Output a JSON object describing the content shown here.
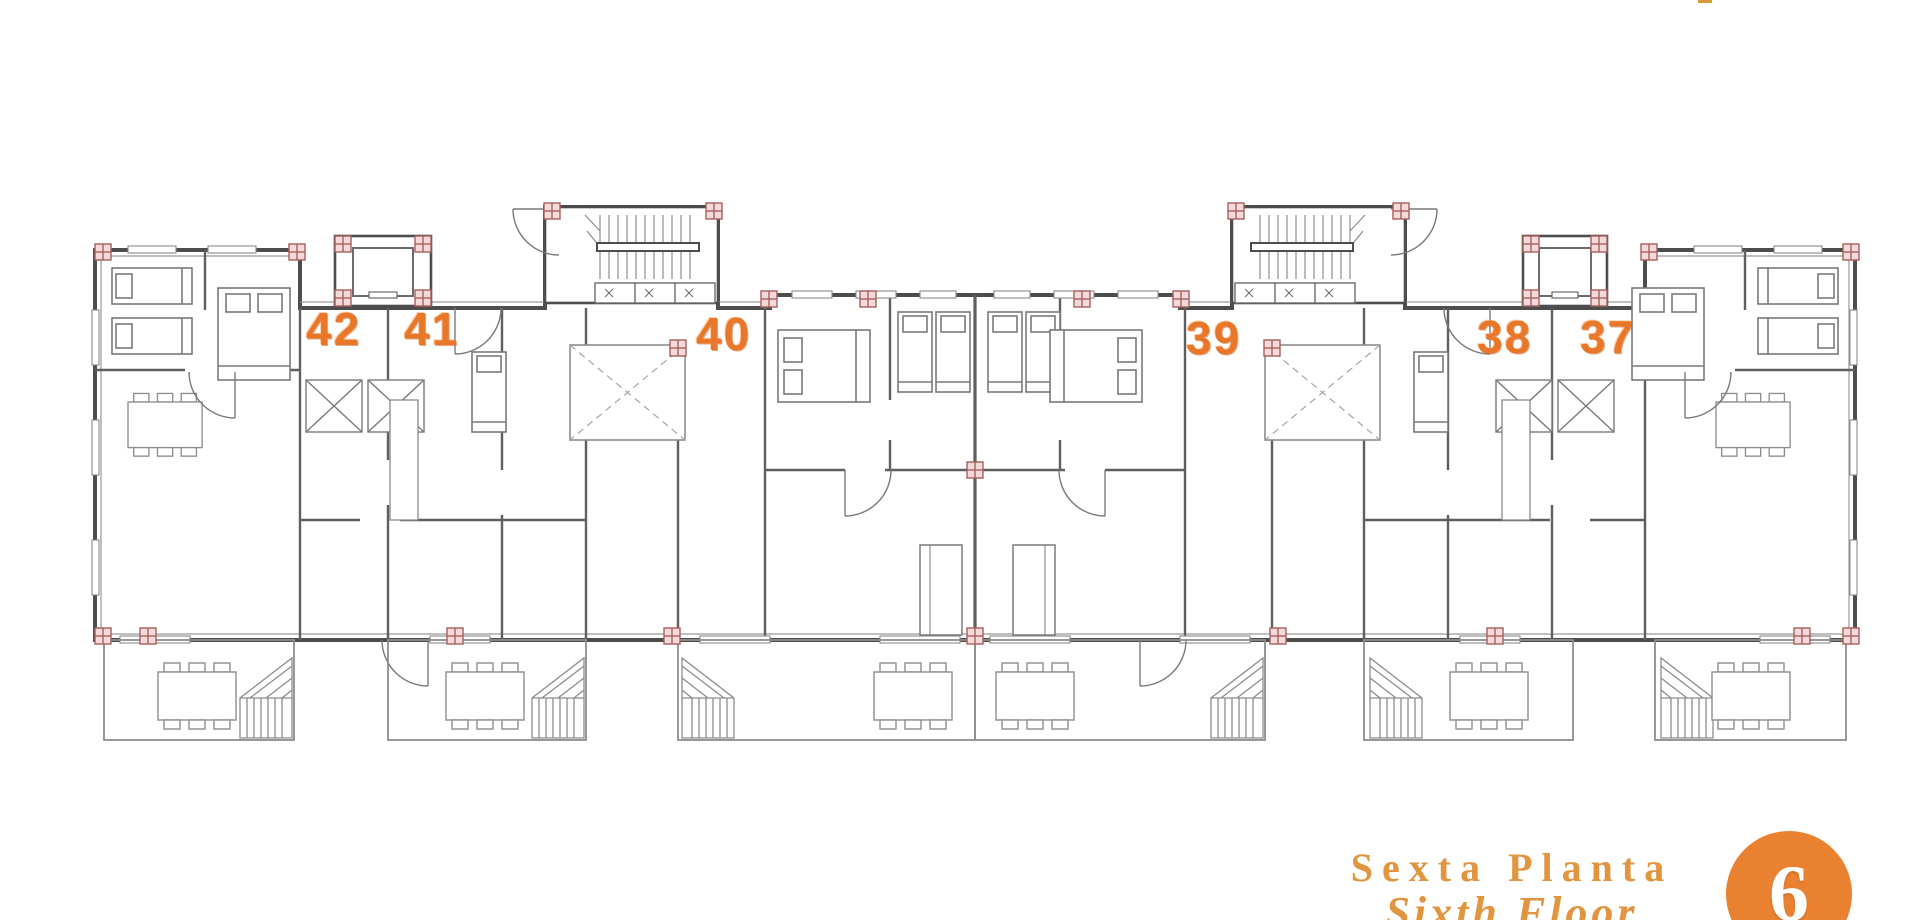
{
  "page": {
    "background_color": "#ffffff"
  },
  "plan": {
    "accent_color": "#e8772a",
    "line_color": "#5a5a5a",
    "column_marker_color": "#a85f5f",
    "units": [
      {
        "number": "42",
        "left": 306,
        "top": 306
      },
      {
        "number": "41",
        "left": 404,
        "top": 306
      },
      {
        "number": "40",
        "left": 696,
        "top": 311
      },
      {
        "number": "39",
        "left": 1186,
        "top": 315
      },
      {
        "number": "38",
        "left": 1477,
        "top": 314
      },
      {
        "number": "37",
        "left": 1580,
        "top": 314
      }
    ]
  },
  "legend": {
    "title_primary": "Sexta Planta",
    "title_secondary": "Sixth Floor",
    "floor_badge": "6",
    "title_color": "#e2953f",
    "badge_color": "#ea8130"
  }
}
